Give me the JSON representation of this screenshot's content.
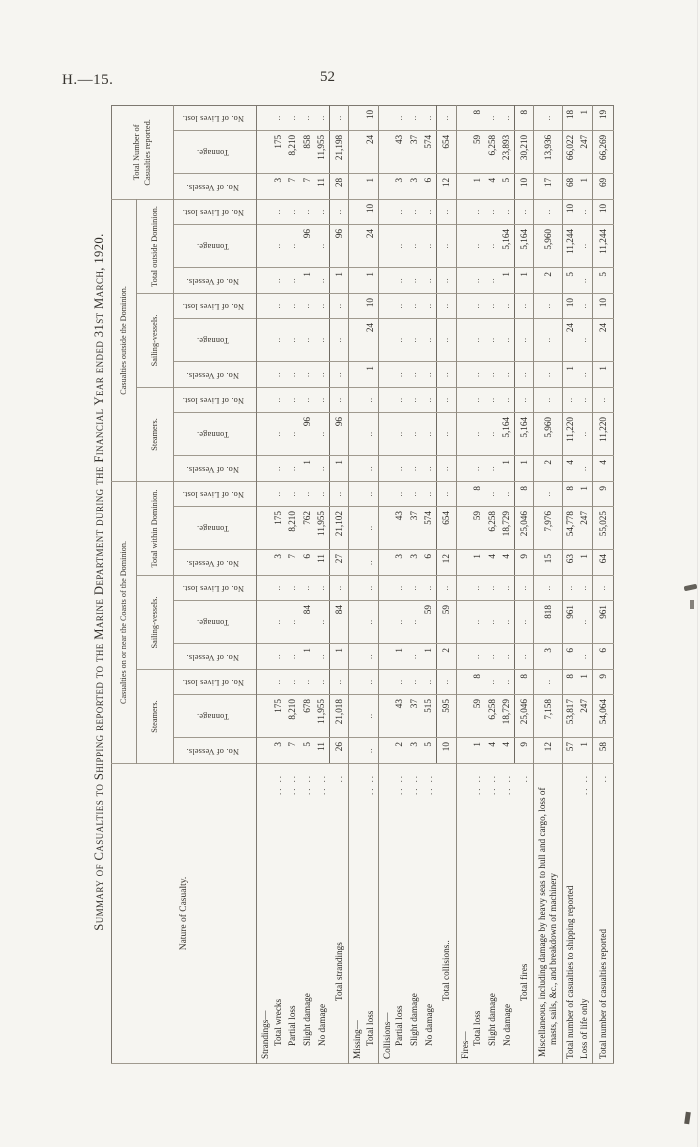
{
  "page_header": {
    "report_code": "H.—15.",
    "page_number": "52"
  },
  "table": {
    "title": "Summary of Casualties to Shipping reported to the Marine Department during the Financial Year ended 31st March, 1920.",
    "empty_cell": "..",
    "columns": {
      "row_label": "Nature of Casualty.",
      "groups": [
        {
          "label": "Casualties on or near the Coasts of the Dominion.",
          "subgroups": [
            "Steamers.",
            "Sailing-vessels.",
            "Total within Dominion."
          ]
        },
        {
          "label": "Casualties outside the Dominion.",
          "subgroups": [
            "Steamers.",
            "Sailing-vessels.",
            "Total outside Dominion."
          ]
        },
        {
          "label": "Total Number of Casualties reported.",
          "subgroups": []
        }
      ],
      "leaf_headers": [
        "No. of Vessels.",
        "Tonnage.",
        "No. of Lives lost."
      ]
    },
    "rows": [
      {
        "type": "group",
        "label": "Strandings—",
        "dots": "",
        "cells": [
          "",
          "",
          "",
          "",
          "",
          "",
          "",
          "",
          "",
          "",
          "",
          "",
          "",
          "",
          "",
          "",
          "",
          "",
          "",
          "",
          ""
        ]
      },
      {
        "type": "item",
        "label": "Total wrecks",
        "dots": "..   ..",
        "cells": [
          "3",
          "175",
          "..",
          "..",
          "..",
          "..",
          "3",
          "175",
          "..",
          "..",
          "..",
          "..",
          "..",
          "..",
          "..",
          "..",
          "..",
          "..",
          "3",
          "175",
          ".."
        ]
      },
      {
        "type": "item",
        "label": "Partial loss",
        "dots": "..   ..",
        "cells": [
          "7",
          "8,210",
          "..",
          "..",
          "..",
          "..",
          "7",
          "8,210",
          "..",
          "..",
          "..",
          "..",
          "..",
          "..",
          "..",
          "..",
          "..",
          "..",
          "7",
          "8,210",
          ".."
        ]
      },
      {
        "type": "item",
        "label": "Slight damage",
        "dots": "..   ..",
        "cells": [
          "5",
          "678",
          "..",
          "1",
          "84",
          "..",
          "6",
          "762",
          "..",
          "1",
          "96",
          "..",
          "..",
          "..",
          "..",
          "1",
          "96",
          "..",
          "7",
          "858",
          ".."
        ]
      },
      {
        "type": "item",
        "label": "No damage",
        "dots": "..   ..",
        "cells": [
          "11",
          "11,955",
          "..",
          "..",
          "..",
          "..",
          "11",
          "11,955",
          "..",
          "..",
          "..",
          "..",
          "..",
          "..",
          "..",
          "..",
          "..",
          "..",
          "11",
          "11,955",
          ".."
        ]
      },
      {
        "type": "total",
        "label": "Total strandings",
        "dots": "..",
        "rule": true,
        "cells": [
          "26",
          "21,018",
          "..",
          "1",
          "84",
          "..",
          "27",
          "21,102",
          "..",
          "1",
          "96",
          "..",
          "..",
          "..",
          "..",
          "1",
          "96",
          "..",
          "28",
          "21,198",
          ".."
        ]
      },
      {
        "type": "group",
        "label": "Missing—",
        "dots": "",
        "cells": [
          "",
          "",
          "",
          "",
          "",
          "",
          "",
          "",
          "",
          "",
          "",
          "",
          "",
          "",
          "",
          "",
          "",
          "",
          "",
          "",
          ""
        ]
      },
      {
        "type": "item",
        "label": "Total loss",
        "dots": "..   ..",
        "rule": true,
        "cells": [
          "..",
          "..",
          "..",
          "..",
          "..",
          "..",
          "..",
          "..",
          "..",
          "..",
          "..",
          "..",
          "1",
          "24",
          "10",
          "1",
          "24",
          "10",
          "1",
          "24",
          "10"
        ]
      },
      {
        "type": "group",
        "label": "Collisions—",
        "dots": "",
        "cells": [
          "",
          "",
          "",
          "",
          "",
          "",
          "",
          "",
          "",
          "",
          "",
          "",
          "",
          "",
          "",
          "",
          "",
          "",
          "",
          "",
          ""
        ]
      },
      {
        "type": "item",
        "label": "Partial loss",
        "dots": "..   ..",
        "cells": [
          "2",
          "43",
          "..",
          "1",
          "..",
          "..",
          "3",
          "43",
          "..",
          "..",
          "..",
          "..",
          "..",
          "..",
          "..",
          "..",
          "..",
          "..",
          "3",
          "43",
          ".."
        ]
      },
      {
        "type": "item",
        "label": "Slight damage",
        "dots": "..   ..",
        "cells": [
          "3",
          "37",
          "..",
          "..",
          "..",
          "..",
          "3",
          "37",
          "..",
          "..",
          "..",
          "..",
          "..",
          "..",
          "..",
          "..",
          "..",
          "..",
          "3",
          "37",
          ".."
        ]
      },
      {
        "type": "item",
        "label": "No damage",
        "dots": "..   ..",
        "cells": [
          "5",
          "515",
          "..",
          "1",
          "59",
          "..",
          "6",
          "574",
          "..",
          "..",
          "..",
          "..",
          "..",
          "..",
          "..",
          "..",
          "..",
          "..",
          "6",
          "574",
          ".."
        ]
      },
      {
        "type": "total",
        "label": "Total collisions..",
        "dots": "",
        "rule": true,
        "cells": [
          "10",
          "595",
          "..",
          "2",
          "59",
          "..",
          "12",
          "654",
          "..",
          "..",
          "..",
          "..",
          "..",
          "..",
          "..",
          "..",
          "..",
          "..",
          "12",
          "654",
          ".."
        ]
      },
      {
        "type": "group",
        "label": "Fires—",
        "dots": "",
        "cells": [
          "",
          "",
          "",
          "",
          "",
          "",
          "",
          "",
          "",
          "",
          "",
          "",
          "",
          "",
          "",
          "",
          "",
          "",
          "",
          "",
          ""
        ]
      },
      {
        "type": "item",
        "label": "Total loss",
        "dots": "..   ..",
        "cells": [
          "1",
          "59",
          "8",
          "..",
          "..",
          "..",
          "1",
          "59",
          "8",
          "..",
          "..",
          "..",
          "..",
          "..",
          "..",
          "..",
          "..",
          "..",
          "1",
          "59",
          "8"
        ]
      },
      {
        "type": "item",
        "label": "Slight damage",
        "dots": "..   ..",
        "cells": [
          "4",
          "6,258",
          "..",
          "..",
          "..",
          "..",
          "4",
          "6,258",
          "..",
          "..",
          "..",
          "..",
          "..",
          "..",
          "..",
          "..",
          "..",
          "..",
          "4",
          "6,258",
          ".."
        ]
      },
      {
        "type": "item",
        "label": "No damage",
        "dots": "..   ..",
        "cells": [
          "4",
          "18,729",
          "..",
          "..",
          "..",
          "..",
          "4",
          "18,729",
          "..",
          "1",
          "5,164",
          "..",
          "..",
          "..",
          "..",
          "1",
          "5,164",
          "..",
          "5",
          "23,893",
          ".."
        ]
      },
      {
        "type": "total",
        "label": "Total fires",
        "dots": "..",
        "rule": true,
        "cells": [
          "9",
          "25,046",
          "8",
          "..",
          "..",
          "..",
          "9",
          "25,046",
          "8",
          "1",
          "5,164",
          "..",
          "..",
          "..",
          "..",
          "1",
          "5,164",
          "..",
          "10",
          "30,210",
          "8"
        ]
      },
      {
        "type": "hang",
        "label": "Miscellaneous, including damage by heavy seas to hull and cargo, loss of masts, sails, &c., and breakdown of machinery",
        "dots": "",
        "rule": true,
        "cells": [
          "12",
          "7,158",
          "..",
          "3",
          "818",
          "..",
          "15",
          "7,976",
          "..",
          "2",
          "5,960",
          "..",
          "..",
          "..",
          "..",
          "2",
          "5,960",
          "..",
          "17",
          "13,936",
          ".."
        ]
      },
      {
        "type": "flush",
        "label": "Total number of casualties to shipping reported",
        "dots": "",
        "cells": [
          "57",
          "53,817",
          "8",
          "6",
          "961",
          "..",
          "63",
          "54,778",
          "8",
          "4",
          "11,220",
          "..",
          "1",
          "24",
          "10",
          "5",
          "11,244",
          "10",
          "68",
          "66,022",
          "18"
        ]
      },
      {
        "type": "flush",
        "label": "Loss of life only",
        "dots": "..   ..",
        "rule": true,
        "cells": [
          "1",
          "247",
          "1",
          "..",
          "..",
          "..",
          "1",
          "247",
          "1",
          "..",
          "..",
          "..",
          "..",
          "..",
          "..",
          "..",
          "..",
          "..",
          "1",
          "247",
          "1"
        ]
      },
      {
        "type": "grand",
        "label": "Total number of casualties reported",
        "dots": "..",
        "cells": [
          "58",
          "54,064",
          "9",
          "6",
          "961",
          "..",
          "64",
          "55,025",
          "9",
          "4",
          "11,220",
          "..",
          "1",
          "24",
          "10",
          "5",
          "11,244",
          "10",
          "69",
          "66,269",
          "19"
        ]
      }
    ]
  }
}
